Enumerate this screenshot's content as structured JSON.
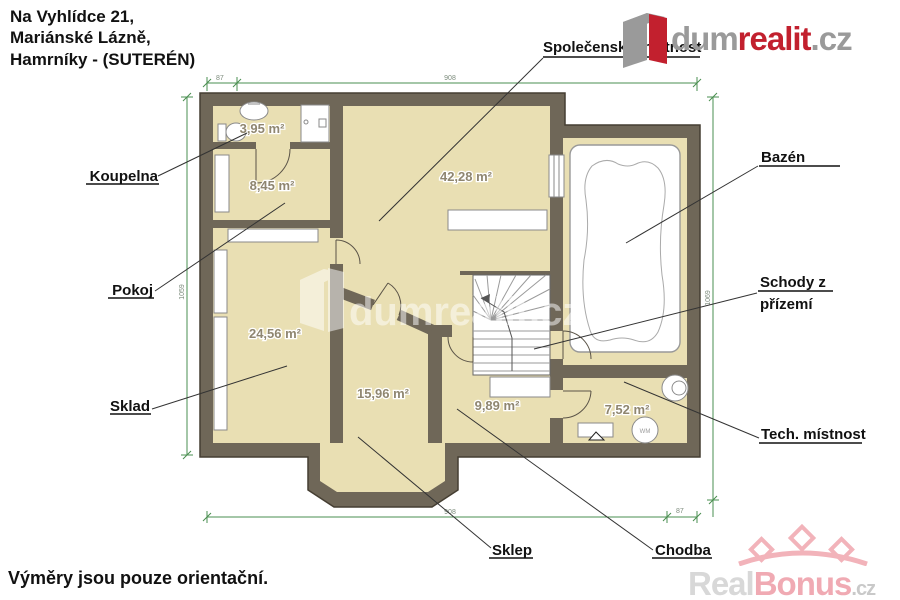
{
  "header": {
    "address_line1": "Na Vyhlídce 21,",
    "address_line2": "Mariánské Lázně,",
    "address_line3": "Hamrníky - (SUTERÉN)"
  },
  "footer": {
    "disclaimer": "Výměry jsou pouze orientační."
  },
  "branding": {
    "logo_dum": "dum",
    "logo_realit": "realit",
    "logo_cz": ".cz",
    "watermark_center": "dumrealit.cz",
    "bonus_real": "Real",
    "bonus_bonus": "Bonus",
    "bonus_cz": ".cz"
  },
  "rooms": {
    "koupelna": {
      "label": "Koupelna",
      "area": "3,95 m²"
    },
    "pokoj": {
      "label": "Pokoj",
      "area": "8,45 m²"
    },
    "sklad": {
      "label": "Sklad",
      "area": "24,56 m²"
    },
    "sklep": {
      "label": "Sklep",
      "area": "15,96 m²"
    },
    "chodba": {
      "label": "Chodba",
      "area": "9,89 m²"
    },
    "tech": {
      "label": "Tech. místnost",
      "area": "7,52 m²"
    },
    "spolecenska": {
      "label": "Společenská místnost",
      "area": "42,28 m²"
    },
    "bazen": {
      "label": "Bazén"
    },
    "schody": {
      "label_line1": "Schody z",
      "label_line2": "přízemí"
    }
  },
  "dimensions": {
    "top": "908",
    "bottom": "908",
    "left": "1059",
    "right": "1069",
    "tick_small": "87"
  },
  "fixtures": {
    "appliance_label": "WM"
  },
  "colors": {
    "floor": "#e9dfb3",
    "wall": "#6f6758",
    "dim_green": "#4a8f50",
    "brand_red": "#c2202e",
    "brand_gray": "#9a9a9a",
    "bonus_pink": "#f0aab3"
  }
}
